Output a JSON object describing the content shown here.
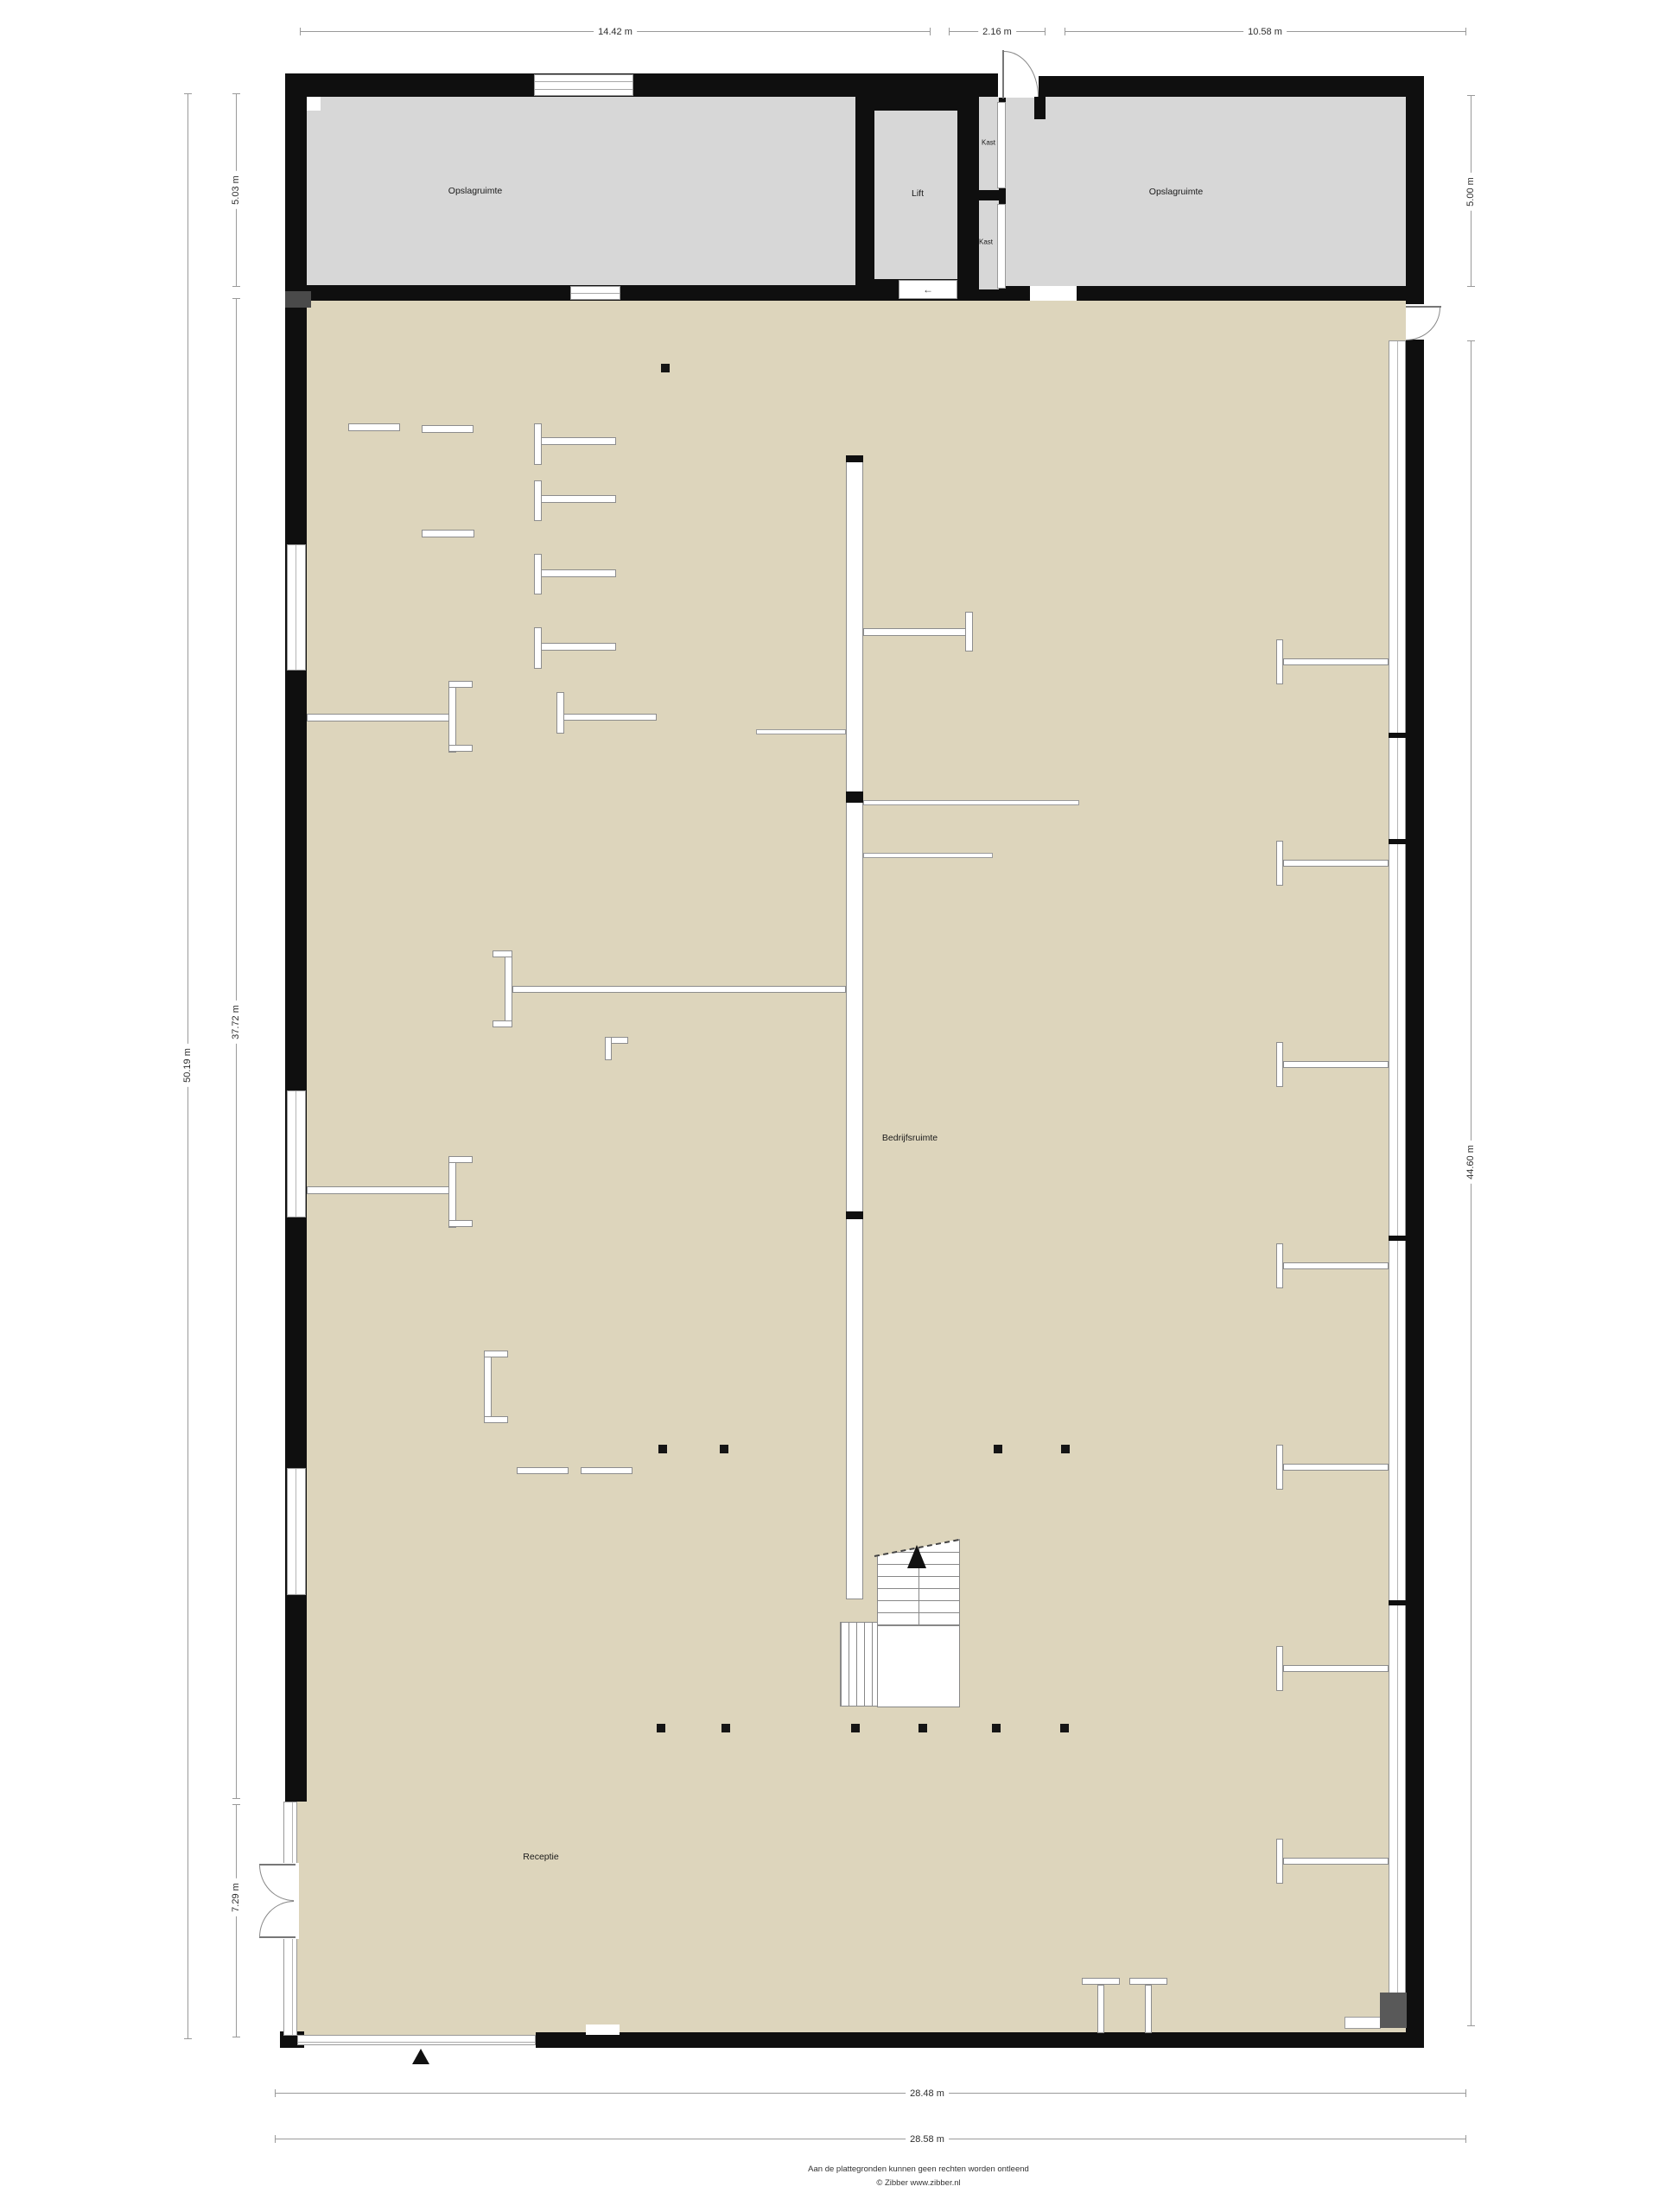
{
  "rooms": {
    "storage_left": "Opslagruimte",
    "storage_right": "Opslagruimte",
    "lift": "Lift",
    "closet_top": "Kast",
    "closet_bottom": "Kast",
    "main_hall": "Bedrijfsruimte",
    "reception": "Receptie"
  },
  "dimensions": {
    "top": {
      "d1": "14.42 m",
      "d2": "2.16 m",
      "d3": "10.58 m"
    },
    "left": {
      "outer": "50.19 m",
      "top": "5.03 m",
      "middle": "37.72 m",
      "bottom": "7.29 m"
    },
    "right": {
      "top": "5.00 m",
      "middle": "44.60 m"
    },
    "bottom": {
      "inner": "28.48 m",
      "outer": "28.58 m"
    }
  },
  "footer": {
    "disclaimer": "Aan de plattegronden kunnen geen rechten worden ontleend",
    "copyright": "© Zibber www.zibber.nl"
  },
  "glyphs": {
    "lift_arrow": "←"
  },
  "colors": {
    "wall": "#0f0f0f",
    "storage_fill": "#d7d7d7",
    "floor_fill": "#ddd5bc",
    "partition_border": "#8d8d8d",
    "dimension_line": "#9a9a9a",
    "dark_inset": "#595959",
    "text": "#2e2e2e"
  }
}
